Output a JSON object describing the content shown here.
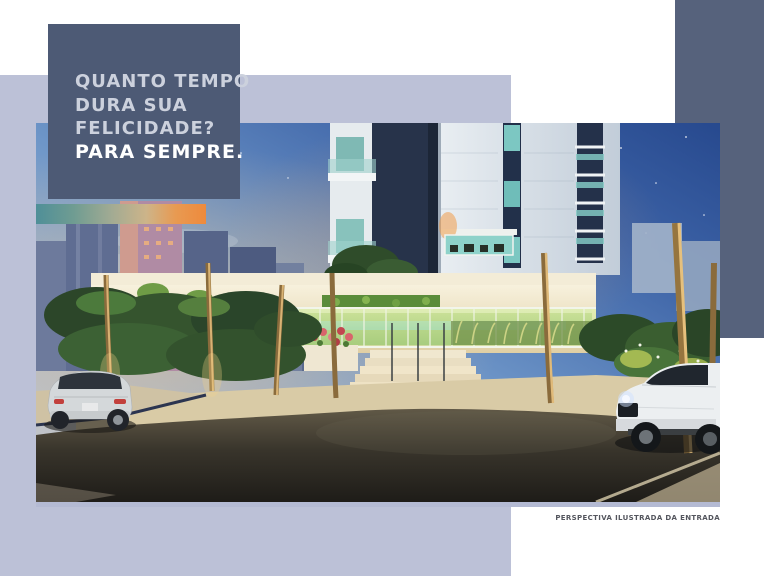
{
  "headline": {
    "lines": [
      "QUANTO TEMPO",
      "DURA SUA",
      "FELICIDADE?"
    ],
    "emphasis": "PARA SEMPRE."
  },
  "caption": {
    "text": "PERSPECTIVA ILUSTRADA DA ENTRADA"
  },
  "photo": {
    "description": "Dusk rendering of a residential tower entrance: palm trees, glowing glass fence, entry stairs, hedges, a silver car at left and a white SUV at right"
  },
  "colors": {
    "background": "#ffffff",
    "lavender_field": "#bcc1d7",
    "headline_box": "#4d5a75",
    "accent_block": "#56627c",
    "headline_text": "#ccd1dd",
    "emphasis_text": "#ffffff",
    "caption_text": "#54565e",
    "gradient_bar_teal": "#4f8f98",
    "gradient_bar_sand": "#cdb489",
    "gradient_bar_orange": "#ee8a3c"
  }
}
